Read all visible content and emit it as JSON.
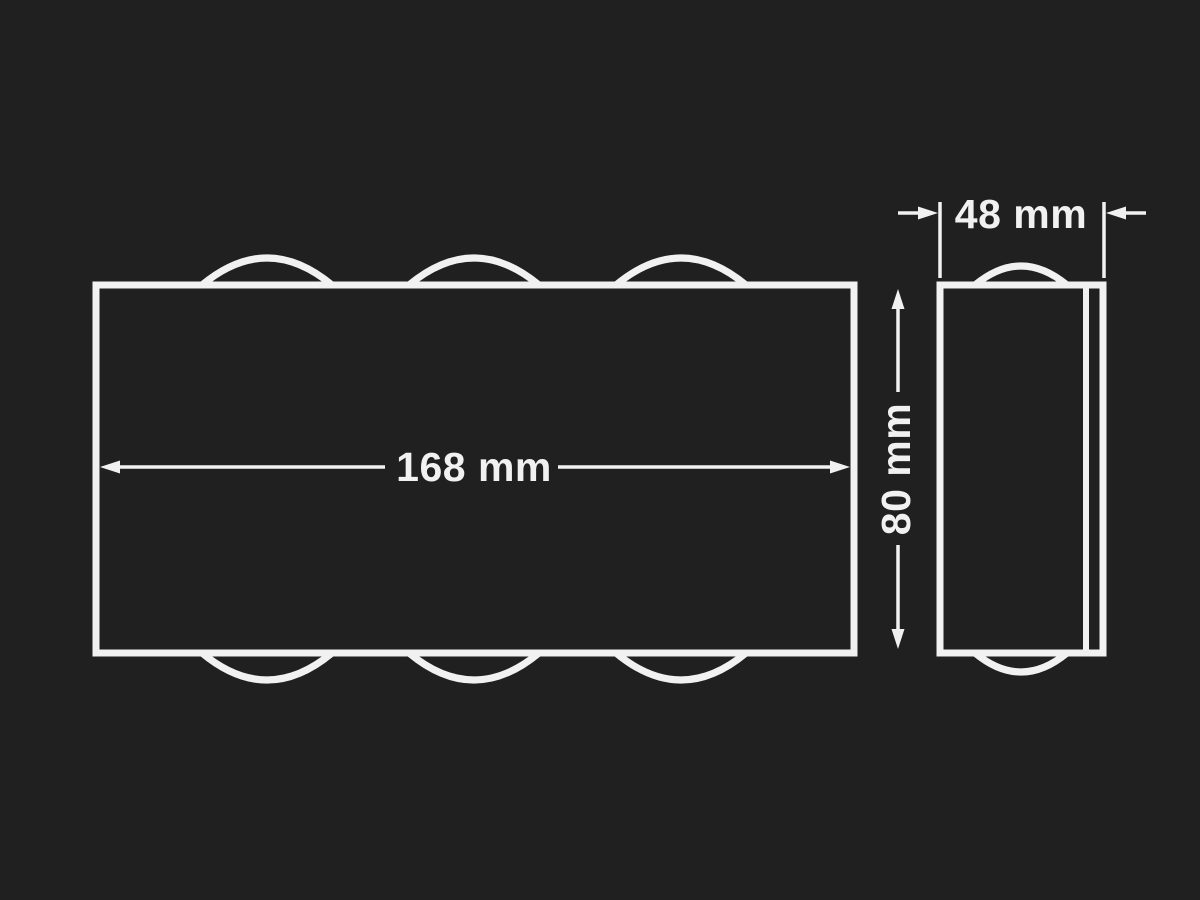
{
  "colors": {
    "background": "#202020",
    "line": "#f1f1f1"
  },
  "front_view": {
    "width_label": "168 mm"
  },
  "side_view": {
    "depth_label": "48 mm",
    "height_label": "80 mm"
  }
}
